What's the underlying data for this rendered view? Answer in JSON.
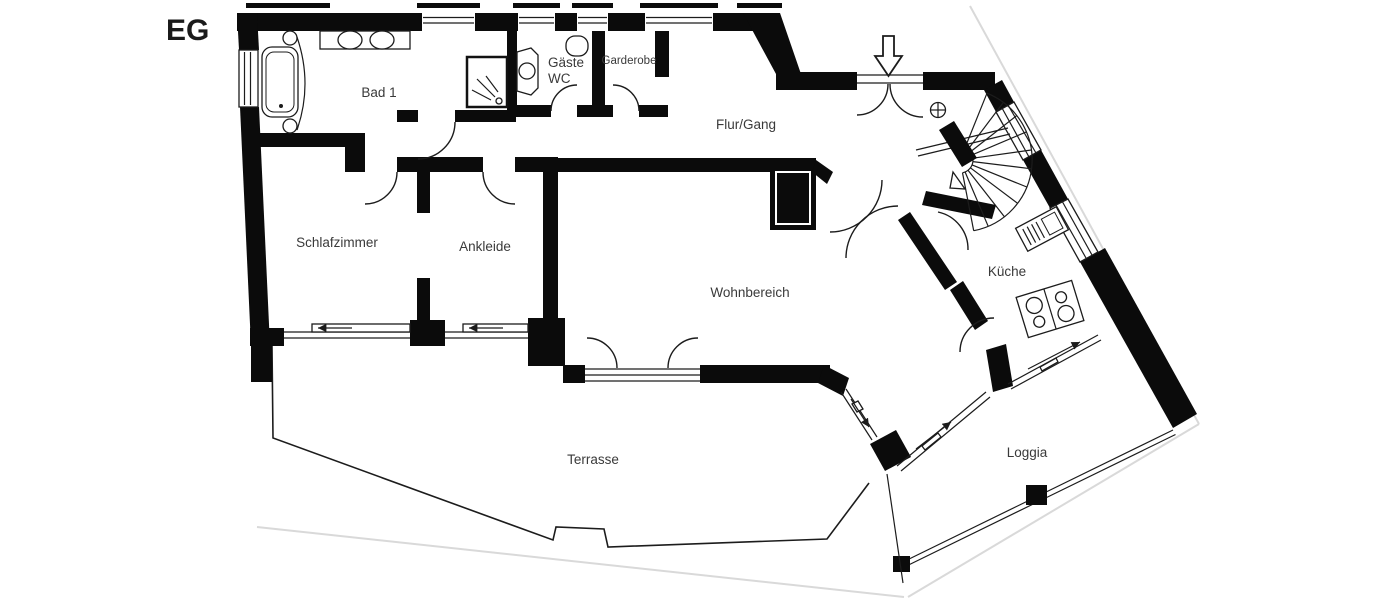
{
  "plan": {
    "title": "EG",
    "labels": {
      "bad1": "Bad 1",
      "gaeste_wc_1": "Gäste",
      "gaeste_wc_2": "WC",
      "garderobe": "Garderobe",
      "flur": "Flur/Gang",
      "schlafzimmer": "Schlafzimmer",
      "ankleide": "Ankleide",
      "wohnbereich": "Wohnbereich",
      "kueche": "Küche",
      "terrasse": "Terrasse",
      "loggia": "Loggia"
    },
    "colors": {
      "wall": "#0b0b0b",
      "line": "#1c1c1c",
      "plot_boundary": "#d9d9d9",
      "label_text": "#3a3a3a",
      "background": "#ffffff"
    },
    "icons": {
      "entrance_arrow": "⇩",
      "stair_center_pole": "⊕"
    }
  }
}
